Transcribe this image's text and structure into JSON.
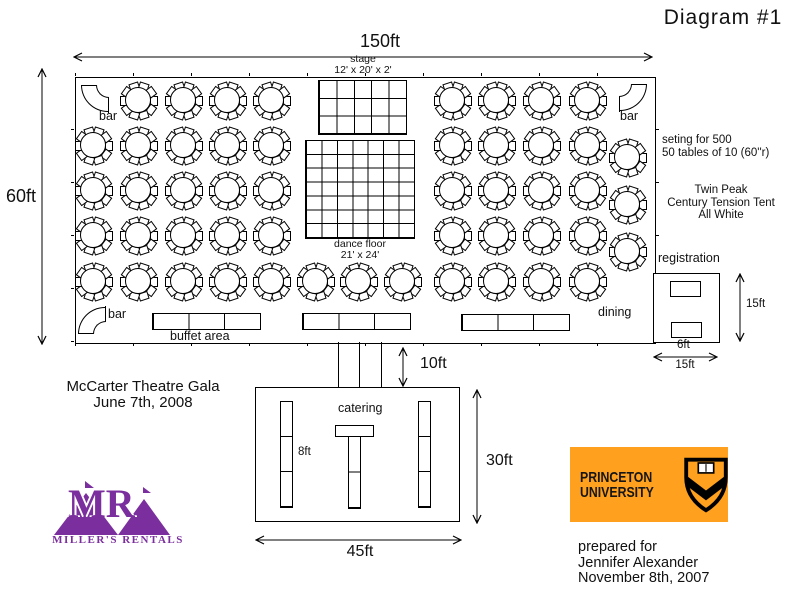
{
  "title": "Diagram #1",
  "tent": {
    "width_label": "150ft",
    "height_label": "60ft",
    "stage": {
      "name": "stage",
      "size": "12' x 20' x 2'"
    },
    "dance_floor": {
      "name": "dance floor",
      "size": "21' x 24'"
    },
    "bar_label": "bar",
    "buffet_label": "buffet area",
    "dining_label": "dining",
    "seating_note_1": "seting for 500",
    "seating_note_2": "50 tables of 10 (60''r)",
    "tent_spec_1": "Twin Peak",
    "tent_spec_2": "Century Tension Tent",
    "tent_spec_3": "All White"
  },
  "registration": {
    "label": "registration",
    "height_label": "15ft",
    "width_label": "15ft",
    "depth_label": "6ft"
  },
  "catering": {
    "label": "catering",
    "corridor_label": "10ft",
    "height_label": "30ft",
    "width_label": "45ft",
    "table_label": "8ft"
  },
  "event": {
    "name": "McCarter Theatre Gala",
    "date": "June 7th, 2008"
  },
  "prepared_for": {
    "line1": "prepared for",
    "line2": "Jennifer Alexander",
    "line3": "November 8th, 2007"
  },
  "logos": {
    "princeton": {
      "line1": "PRINCETON",
      "line2": "UNIVERSITY",
      "bg_color": "#FFA01E",
      "ink_color": "#161616"
    },
    "millers": {
      "monogram": "MR",
      "name": "MILLER'S RENTALS",
      "color": "#7B2F9E"
    }
  },
  "layout": {
    "guest_tables": {
      "count": 50,
      "positions": [
        [
          138,
          100
        ],
        [
          183,
          100
        ],
        [
          227,
          100
        ],
        [
          271,
          100
        ],
        [
          452,
          100
        ],
        [
          496,
          100
        ],
        [
          541,
          100
        ],
        [
          587,
          100
        ],
        [
          93,
          145
        ],
        [
          138,
          145
        ],
        [
          183,
          145
        ],
        [
          227,
          145
        ],
        [
          271,
          145
        ],
        [
          452,
          145
        ],
        [
          496,
          145
        ],
        [
          541,
          145
        ],
        [
          587,
          145
        ],
        [
          93,
          190
        ],
        [
          138,
          190
        ],
        [
          183,
          190
        ],
        [
          227,
          190
        ],
        [
          271,
          190
        ],
        [
          452,
          190
        ],
        [
          496,
          190
        ],
        [
          541,
          190
        ],
        [
          587,
          190
        ],
        [
          93,
          235
        ],
        [
          138,
          235
        ],
        [
          183,
          235
        ],
        [
          227,
          235
        ],
        [
          271,
          235
        ],
        [
          452,
          235
        ],
        [
          496,
          235
        ],
        [
          541,
          235
        ],
        [
          587,
          235
        ],
        [
          627,
          157
        ],
        [
          627,
          204
        ],
        [
          627,
          251
        ],
        [
          93,
          281
        ],
        [
          138,
          281
        ],
        [
          183,
          281
        ],
        [
          227,
          281
        ],
        [
          271,
          281
        ],
        [
          315,
          281
        ],
        [
          358,
          281
        ],
        [
          402,
          281
        ],
        [
          452,
          281
        ],
        [
          496,
          281
        ],
        [
          541,
          281
        ],
        [
          587,
          281
        ]
      ]
    },
    "stage_grid": {
      "cols": 5,
      "rows": 3
    },
    "dance_grid": {
      "cols": 7,
      "rows": 7
    }
  }
}
